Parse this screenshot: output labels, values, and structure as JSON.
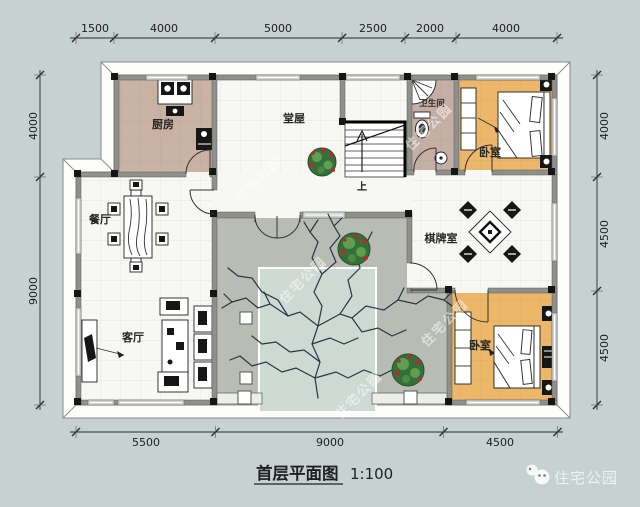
{
  "title": {
    "name": "首层平面图",
    "scale": "1:100"
  },
  "brand": {
    "name": "住宅公园"
  },
  "watermark": {
    "text": "住宅公园"
  },
  "dimensions": {
    "top": [
      "1500",
      "4000",
      "5000",
      "2500",
      "2000",
      "4000"
    ],
    "bottom": [
      "5500",
      "9000",
      "4500"
    ],
    "left": [
      "4000",
      "9000"
    ],
    "right": [
      "4000",
      "4500",
      "4500"
    ]
  },
  "rooms": {
    "kitchen": "厨房",
    "hall": "堂屋",
    "bathroom": "卫生间",
    "bedroom_top": "卧室",
    "dining": "餐厅",
    "living": "客厅",
    "chess": "棋牌室",
    "bedroom_bottom": "卧室"
  },
  "stairs": {
    "up": "上"
  },
  "colors": {
    "background": "#c6d1d1",
    "wall": "#8f908a",
    "kitchen_floor": "#c9b2a3",
    "bath_floor": "#c4afa5",
    "bedroom_floor": "#ecb768",
    "courtyard": "#b9bcb5",
    "inner_court": "#cdd9d3",
    "room_floor": "#f7f7f4"
  }
}
